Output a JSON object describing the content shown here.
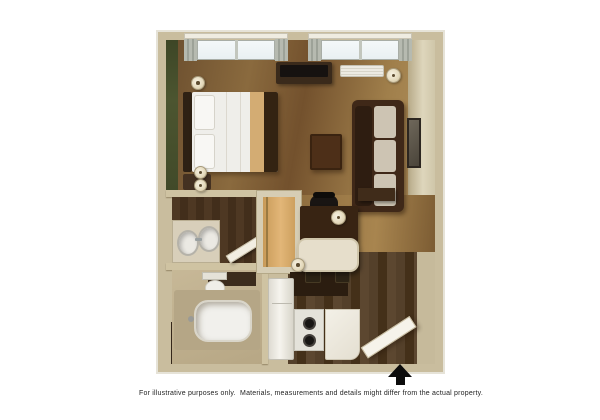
{
  "caption": "For illustrative purposes only.  Materials, measurements and details might differ from the actual property.",
  "floorplan": {
    "kind": "3d-rendered studio suite floor plan",
    "icons": {
      "north_arrow": "north-arrow-icon"
    },
    "rooms": [
      "bedroom-living-area",
      "vanity-room",
      "bathroom",
      "closet",
      "kitchen",
      "dining-desk-nook"
    ],
    "furniture": [
      "bed",
      "headboard",
      "pillows",
      "bed-runner",
      "sofa",
      "coffee-table",
      "tv-stand",
      "tv",
      "air-conditioner",
      "wall-sconces",
      "floor-lamp",
      "wall-mirror",
      "double-sink-vanity",
      "toilet",
      "bathtub",
      "closet-shelving",
      "desk",
      "office-chair",
      "desk-lamp",
      "wall-shelf",
      "dining-table",
      "dining-chairs",
      "table-lamp",
      "refrigerator",
      "stove",
      "kitchen-counter",
      "entry-door",
      "windows-with-curtains"
    ],
    "palette": {
      "background": "#ffffff",
      "wall_beige": "#c9bd9e",
      "accent_wall_green": "#4c5530",
      "bedroom_floor": "#8a6a3e",
      "kitchen_floor_dark": "#4a3622",
      "bathroom_floor": "#c0b190",
      "sofa_brown": "#3f2818",
      "bed_runner_tan": "#d3ac73",
      "linens_white": "#efeeea",
      "arrow_black": "#0c0c0c"
    }
  }
}
